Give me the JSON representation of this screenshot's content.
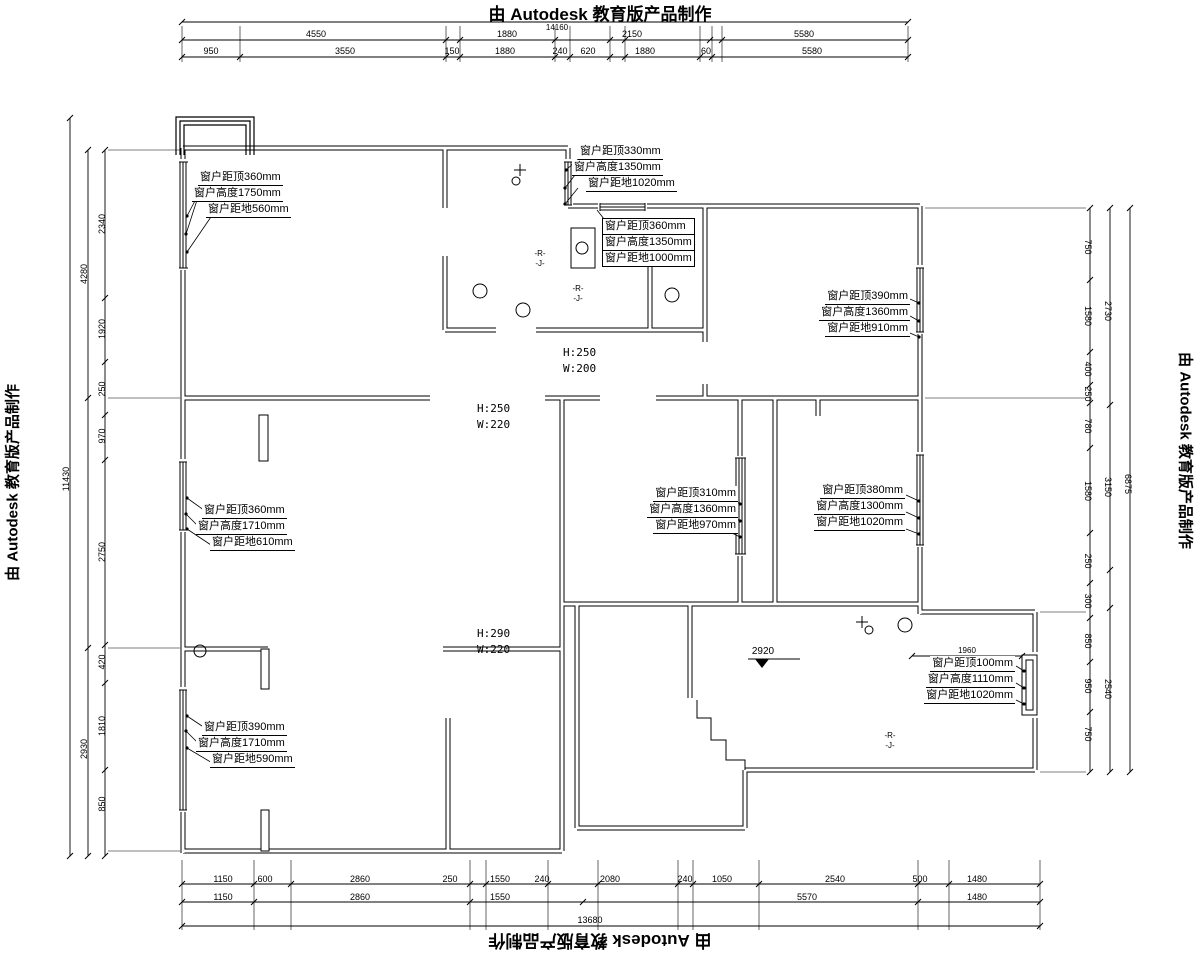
{
  "watermarks": {
    "top": "由 Autodesk 教育版产品制作",
    "bottom": "由 Autodesk 教育版产品制作",
    "left": "由 Autodesk 教育版产品制作",
    "right": "由 Autodesk 教育版产品制作"
  },
  "window_labels": {
    "w1": {
      "l1": "窗户距顶360mm",
      "l2": "窗户高度1750mm",
      "l3": "窗户距地560mm"
    },
    "w2": {
      "l1": "窗户距顶330mm",
      "l2": "窗户高度1350mm",
      "l3": "窗户距地1020mm"
    },
    "w3": {
      "l1": "窗户距顶360mm",
      "l2": "窗户高度1350mm",
      "l3": "窗户距地1000mm"
    },
    "w4": {
      "l1": "窗户距顶390mm",
      "l2": "窗户高度1360mm",
      "l3": "窗户距地910mm"
    },
    "w5": {
      "l1": "窗户距顶360mm",
      "l2": "窗户高度1710mm",
      "l3": "窗户距地610mm"
    },
    "w6": {
      "l1": "窗户距顶310mm",
      "l2": "窗户高度1360mm",
      "l3": "窗户距地970mm"
    },
    "w7": {
      "l1": "窗户距顶380mm",
      "l2": "窗户高度1300mm",
      "l3": "窗户距地1020mm"
    },
    "w8": {
      "l1": "窗户距顶390mm",
      "l2": "窗户高度1710mm",
      "l3": "窗户距地590mm"
    },
    "w9": {
      "l1": "窗户距顶100mm",
      "l2": "窗户高度1110mm",
      "l3": "窗户距地1020mm"
    }
  },
  "beams": {
    "b1": {
      "h": "H:250",
      "w": "W:200"
    },
    "b2": {
      "h": "H:250",
      "w": "W:220"
    },
    "b3": {
      "h": "H:290",
      "w": "W:220"
    }
  },
  "elevation": "2920",
  "aux": {
    "window_width": "1960",
    "top_total": "14160",
    "bottom_total": "13680"
  },
  "dims": {
    "top1": [
      "4550",
      "1880",
      "2150",
      "5580"
    ],
    "top2": [
      "950",
      "3550",
      "150",
      "1880",
      "240",
      "620",
      "1880",
      "60",
      "5580"
    ],
    "bottom1": [
      "1150",
      "600",
      "2860",
      "250",
      "1550",
      "240",
      "2080",
      "240",
      "1050",
      "2540",
      "500",
      "1480"
    ],
    "bottom2": [
      "1150",
      "2860",
      "1550",
      "5570",
      "1480"
    ],
    "left_inner": [
      "2340",
      "1920",
      "250",
      "970",
      "2750",
      "420",
      "1810",
      "850"
    ],
    "left_mid": [
      "4280",
      "2930"
    ],
    "left_total": "11430",
    "right_inner": [
      "750",
      "1580",
      "400",
      "250",
      "780",
      "1580",
      "250",
      "300",
      "850",
      "950",
      "750"
    ],
    "right_mid": [
      "2730",
      "3150",
      "2540"
    ],
    "right_total": "6875"
  },
  "symbols": {
    "drain_a": "-R-",
    "drain_b": "-J-"
  }
}
